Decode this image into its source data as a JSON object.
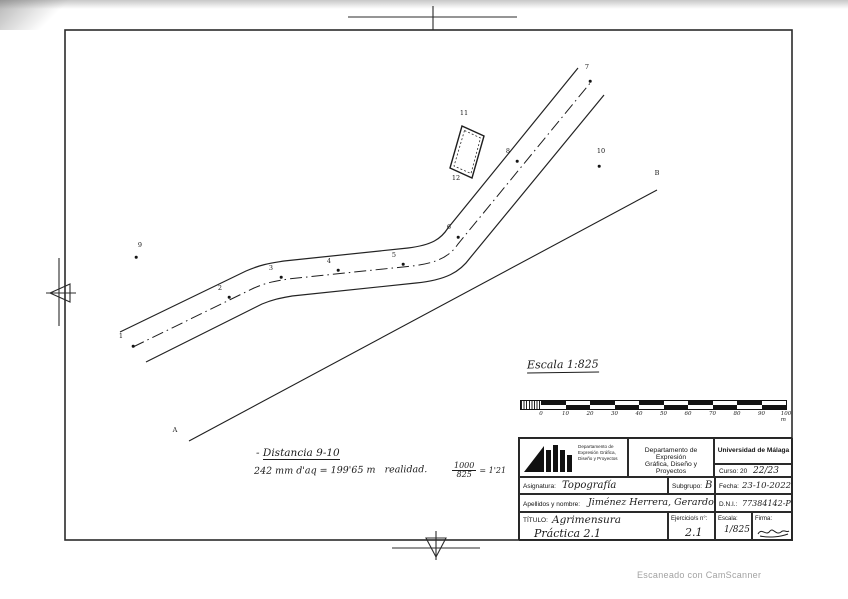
{
  "colors": {
    "ink": "#222222",
    "paper": "#ffffff",
    "watermark_gray": "#a2a2a2"
  },
  "page": {
    "watermark": "Escaneado con CamScanner"
  },
  "map": {
    "scale_note": "Escala 1:825",
    "notes": {
      "distance_bullet": "-",
      "distance_title": "Distancia 9-10",
      "formula": "242 mm d'aq = 199'65 m   realidad.",
      "fraction_numerator": "1000",
      "fraction_denominator": "825",
      "fraction_result": "= 1'21"
    },
    "points": [
      {
        "label": "1",
        "lx": 121,
        "ly": 340,
        "dx": 133,
        "dy": 346
      },
      {
        "label": "2",
        "lx": 220,
        "ly": 292,
        "dx": 229,
        "dy": 297
      },
      {
        "label": "3",
        "lx": 271,
        "ly": 272,
        "dx": 281,
        "dy": 277
      },
      {
        "label": "4",
        "lx": 329,
        "ly": 265,
        "dx": 338,
        "dy": 270
      },
      {
        "label": "5",
        "lx": 394,
        "ly": 259,
        "dx": 403,
        "dy": 264
      },
      {
        "label": "6",
        "lx": 449,
        "ly": 231,
        "dx": 458,
        "dy": 237
      },
      {
        "label": "7",
        "lx": 587,
        "ly": 71,
        "dx": 590,
        "dy": 81
      },
      {
        "label": "8",
        "lx": 508,
        "ly": 155,
        "dx": 517,
        "dy": 161
      },
      {
        "label": "9",
        "lx": 140,
        "ly": 249,
        "dx": 136,
        "dy": 257
      },
      {
        "label": "10",
        "lx": 601,
        "ly": 155,
        "dx": 599,
        "dy": 166
      },
      {
        "label": "11",
        "lx": 464,
        "ly": 117
      },
      {
        "label": "12",
        "lx": 456,
        "ly": 182
      },
      {
        "label": "A",
        "lx": 175,
        "ly": 434
      },
      {
        "label": "B",
        "lx": 657,
        "ly": 177
      }
    ],
    "scale_bar": {
      "ticks": [
        "0",
        "10",
        "20",
        "30",
        "40",
        "50",
        "60",
        "70",
        "80",
        "90",
        "100 m"
      ]
    }
  },
  "title_block": {
    "logo_caption": [
      "Departamento de",
      "Expresión Gráfica,",
      "Diseño y Proyectos"
    ],
    "department_line1": "Departamento de Expresión",
    "department_line2": "Gráfica, Diseño y Proyectos",
    "university": "Universidad de Málaga",
    "curso_label": "Curso: 20",
    "curso_value": "22/23",
    "asignatura_label": "Asignatura:",
    "asignatura_value": "Topografía",
    "subgrupo_label": "Subgrupo:",
    "subgrupo_value": "B",
    "fecha_label": "Fecha:",
    "fecha_value": "23-10-2022",
    "apellidos_label": "Apellidos y nombre:",
    "apellidos_value": "Jiménez Herrera, Gerardo",
    "dni_label": "D.N.I.:",
    "dni_value": "77384142-P",
    "titulo_label": "TÍTULO:",
    "titulo_value": "Agrimensura",
    "titulo_value2": "Práctica 2.1",
    "ejercicio_label": "Ejercicio/s n°:",
    "ejercicio_value": "2.1",
    "escala_label": "Escala:",
    "escala_value": "1/825",
    "firma_label": "Firma:"
  }
}
